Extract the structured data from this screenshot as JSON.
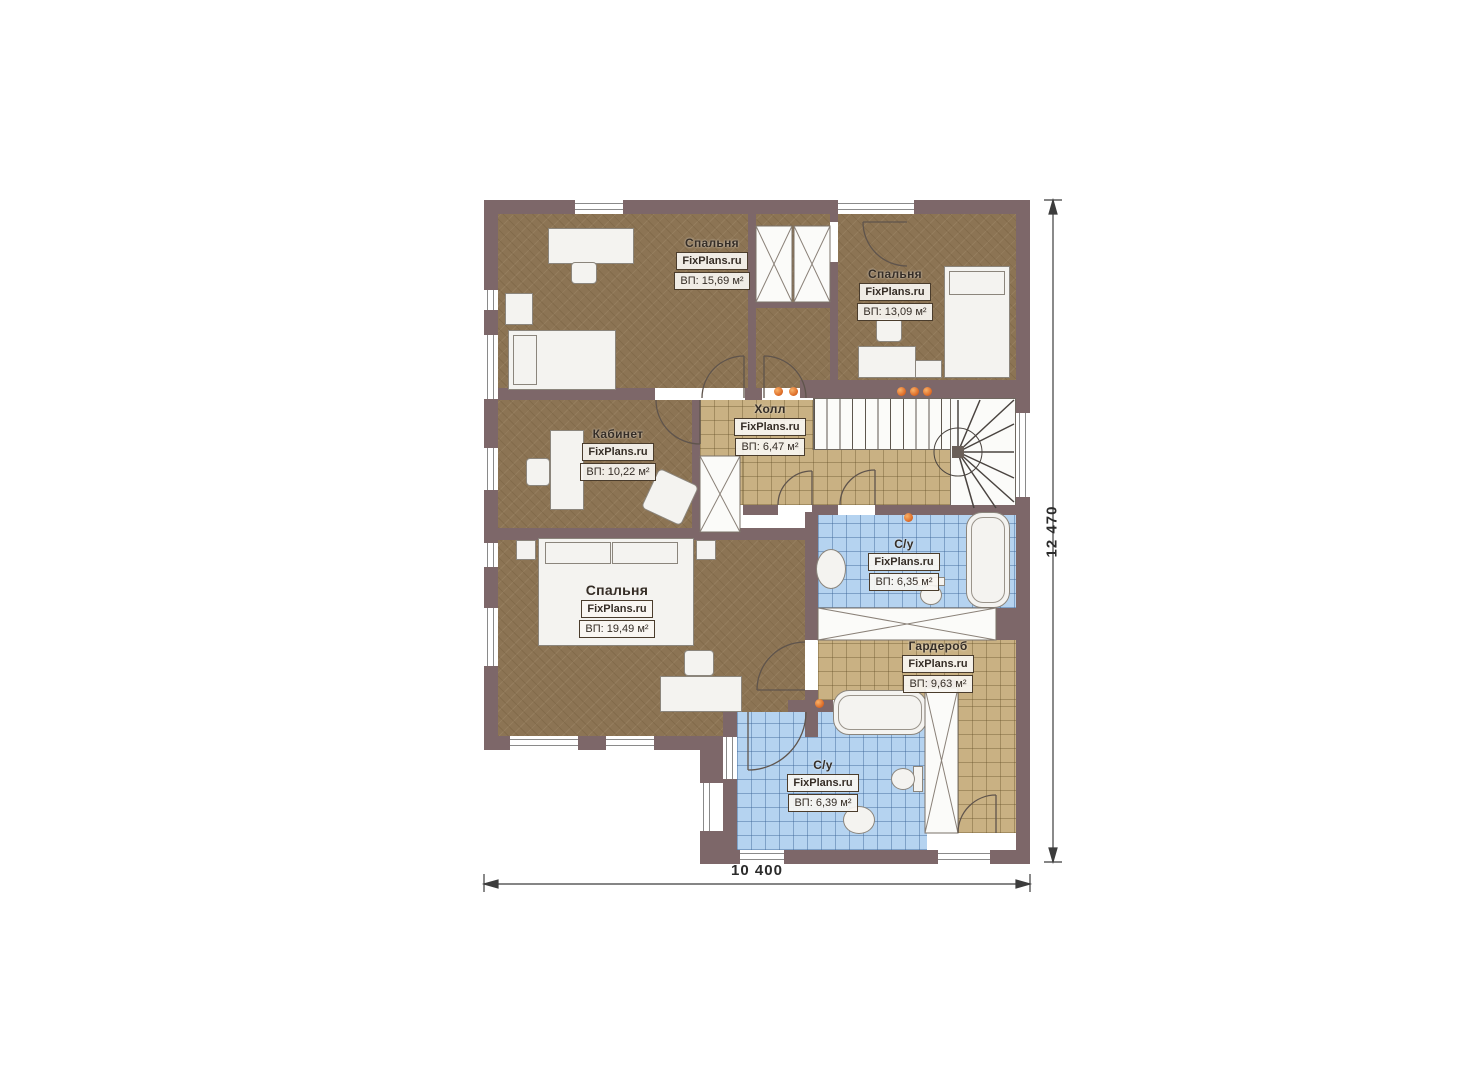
{
  "plan": {
    "title": "Floor plan (second level)",
    "watermark": "FixPlans.ru",
    "rooms": [
      {
        "id": "bedroom-1",
        "name": "Спальня",
        "watermark": "FixPlans.ru",
        "area": "ВП: 15,69 м²"
      },
      {
        "id": "bedroom-2",
        "name": "Спальня",
        "watermark": "FixPlans.ru",
        "area": "ВП: 13,09 м²"
      },
      {
        "id": "office",
        "name": "Кабинет",
        "watermark": "FixPlans.ru",
        "area": "ВП: 10,22 м²"
      },
      {
        "id": "hall",
        "name": "Холл",
        "watermark": "FixPlans.ru",
        "area": "ВП: 6,47 м²"
      },
      {
        "id": "bedroom-3",
        "name": "Спальня",
        "watermark": "FixPlans.ru",
        "area": "ВП: 19,49 м²"
      },
      {
        "id": "bathroom-1",
        "name": "С/у",
        "watermark": "FixPlans.ru",
        "area": "ВП: 6,35 м²"
      },
      {
        "id": "wardrobe",
        "name": "Гардероб",
        "watermark": "FixPlans.ru",
        "area": "ВП: 9,63 м²"
      },
      {
        "id": "bathroom-2",
        "name": "С/у",
        "watermark": "FixPlans.ru",
        "area": "ВП: 6,39 м²"
      }
    ],
    "dimensions": {
      "width_label": "10 400",
      "height_label": "12 470"
    },
    "colors": {
      "wall": "#7d6769",
      "bedroom_floor": "#8c7454",
      "tile_floor": "#c9b183",
      "bath_floor": "#b5d3f0",
      "accent_dot": "#e0712c"
    }
  }
}
